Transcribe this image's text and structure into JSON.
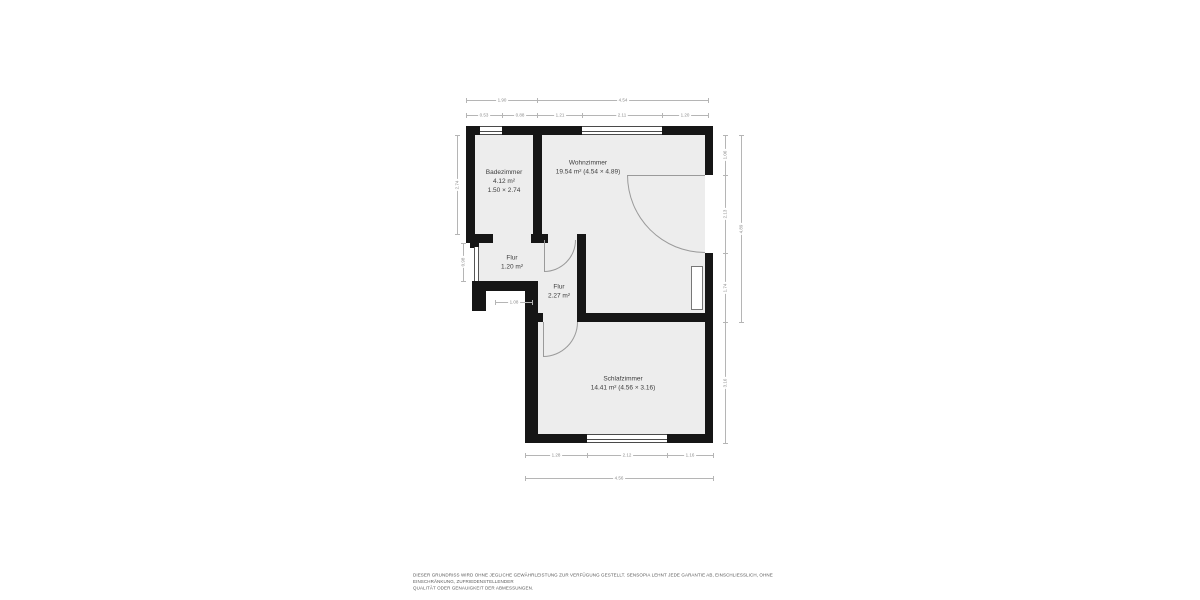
{
  "floorplan": {
    "colors": {
      "wall": "#161616",
      "floor": "#ededed",
      "dim_line": "#b5b5b5",
      "dim_text": "#8c8c8c",
      "room_text": "#3d3d3d"
    },
    "rooms": [
      {
        "id": "badezimmer",
        "label_lines": [
          "Badezimmer",
          "4.12 m²",
          "1.50 × 2.74"
        ],
        "cx": 504,
        "cy": 181
      },
      {
        "id": "wohnzimmer",
        "label_lines": [
          "Wohnzimmer",
          "19.54 m² (4.54 × 4.89)"
        ],
        "cx": 588,
        "cy": 167
      },
      {
        "id": "flur-1",
        "label_lines": [
          "Flur",
          "1.20 m²"
        ],
        "cx": 512,
        "cy": 262
      },
      {
        "id": "flur-2",
        "label_lines": [
          "Flur",
          "2.27 m²"
        ],
        "cx": 559,
        "cy": 291
      },
      {
        "id": "schlafzimmer",
        "label_lines": [
          "Schlafzimmer",
          "14.41 m² (4.56 × 3.16)"
        ],
        "cx": 623,
        "cy": 383
      }
    ],
    "dimensions": [
      {
        "value": "1.90",
        "x1": 466,
        "y1": 100,
        "x2": 537,
        "y2": 100
      },
      {
        "value": "4.54",
        "x1": 537,
        "y1": 100,
        "x2": 708,
        "y2": 100
      },
      {
        "value": "0.53",
        "x1": 466,
        "y1": 115,
        "x2": 502,
        "y2": 115
      },
      {
        "value": "0.88",
        "x1": 502,
        "y1": 115,
        "x2": 537,
        "y2": 115
      },
      {
        "value": "1.21",
        "x1": 537,
        "y1": 115,
        "x2": 582,
        "y2": 115
      },
      {
        "value": "2.11",
        "x1": 582,
        "y1": 115,
        "x2": 662,
        "y2": 115
      },
      {
        "value": "1.20",
        "x1": 662,
        "y1": 115,
        "x2": 708,
        "y2": 115
      },
      {
        "value": "2.74",
        "x1": 457,
        "y1": 135,
        "x2": 457,
        "y2": 234,
        "rot": true
      },
      {
        "value": "0.98",
        "x1": 463,
        "y1": 243,
        "x2": 463,
        "y2": 281,
        "rot": true
      },
      {
        "value": "1.08",
        "x1": 495,
        "y1": 302,
        "x2": 532,
        "y2": 302
      },
      {
        "value": "1.06",
        "x1": 725,
        "y1": 135,
        "x2": 725,
        "y2": 175,
        "rot": true
      },
      {
        "value": "2.13",
        "x1": 725,
        "y1": 175,
        "x2": 725,
        "y2": 253,
        "rot": true
      },
      {
        "value": "1.74",
        "x1": 725,
        "y1": 253,
        "x2": 725,
        "y2": 322,
        "rot": true
      },
      {
        "value": "4.89",
        "x1": 741,
        "y1": 135,
        "x2": 741,
        "y2": 322,
        "rot": true
      },
      {
        "value": "3.16",
        "x1": 725,
        "y1": 322,
        "x2": 725,
        "y2": 443,
        "rot": true
      },
      {
        "value": "1.28",
        "x1": 525,
        "y1": 455,
        "x2": 587,
        "y2": 455
      },
      {
        "value": "2.12",
        "x1": 587,
        "y1": 455,
        "x2": 667,
        "y2": 455
      },
      {
        "value": "1.16",
        "x1": 667,
        "y1": 455,
        "x2": 713,
        "y2": 455
      },
      {
        "value": "4.56",
        "x1": 525,
        "y1": 478,
        "x2": 713,
        "y2": 478
      }
    ]
  },
  "footer": {
    "line1": "DIESER GRUNDRISS WIRD OHNE JEGLICHE GEWÄHRLEISTUNG ZUR VERFÜGUNG GESTELLT. SENSOPIA LEHNT JEDE GARANTIE AB, EINSCHLIESSLICH, OHNE EINSCHRÄNKUNG, ZUFRIEDENSTELLENDER",
    "line2": "QUALITÄT ODER GENAUIGKEIT DER ABMESSUNGEN."
  }
}
